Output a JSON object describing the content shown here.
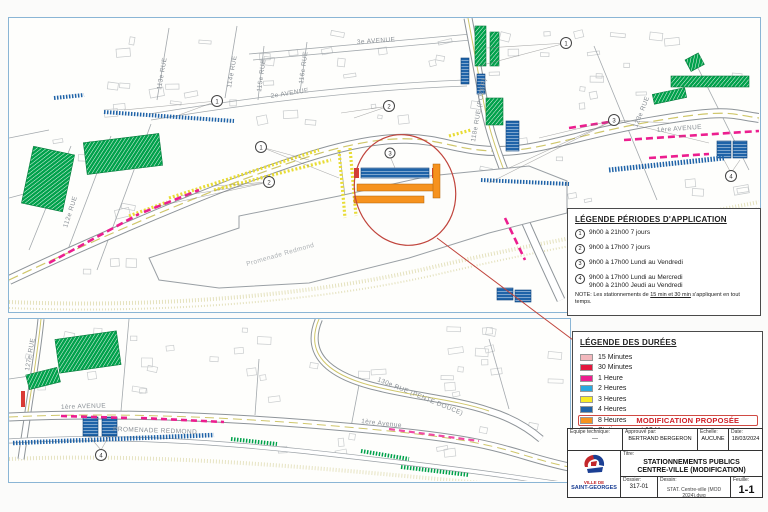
{
  "doc": {
    "type_note": "Scanned municipal parking plan sheet"
  },
  "colors": {
    "panel_border": "#8ab5d5",
    "magenta": "#ec1e8f",
    "yellow": "#efe33a",
    "green": "#00a14b",
    "blue_dark": "#1f63a8",
    "blue_light": "#2aa9e0",
    "orange": "#f6921e",
    "red": "#d93a35",
    "pink_15min": "#f2b8bd",
    "red_30min": "#e3173e",
    "callout_red": "#c0443c"
  },
  "top_map": {
    "labels": {
      "ave3": "3e AVENUE",
      "ave2": "2e AVENUE",
      "ave1": "1ère AVENUE",
      "rue112": "112e RUE",
      "rue113": "113e RUE",
      "rue114": "114e RUE",
      "rue115": "115e RUE",
      "rue116": "116e RUE",
      "rue118": "118e RUE (POZER)",
      "rue123": "123e RUE",
      "promenade": "Promenade Redmond"
    },
    "markers": [
      "1",
      "2",
      "1",
      "2",
      "1",
      "3",
      "3",
      "4"
    ]
  },
  "bottom_map": {
    "labels": {
      "rue127": "127e RUE",
      "ave1": "1ère AVENUE",
      "ave1b": "1ère Avenue",
      "rue130": "130e RUE (PENTE DOUCE)",
      "promenade": "PROMENADE REDMOND"
    },
    "markers": [
      "4"
    ]
  },
  "legend_periods": {
    "title": "LÉGENDE PÉRIODES D'APPLICATION",
    "items": [
      {
        "num": "1",
        "lines": [
          "9h00 à 21h00 7 jours"
        ]
      },
      {
        "num": "2",
        "lines": [
          "9h00 à 17h00 7 jours"
        ]
      },
      {
        "num": "3",
        "lines": [
          "9h00 à 17h00 Lundi au Vendredi"
        ]
      },
      {
        "num": "4",
        "lines": [
          "9h00 à 17h00 Lundi au Mercredi",
          "9h00 à 21h00 Jeudi au Vendredi"
        ]
      }
    ],
    "note_prefix": "NOTE: Les stationnements de ",
    "note_underline": "15 min et 30 min",
    "note_suffix": " s'appliquent en tout temps."
  },
  "legend_durations": {
    "title": "LÉGENDE DES DURÉES",
    "items": [
      {
        "label": "15 Minutes",
        "color": "#f2b8bd"
      },
      {
        "label": "30 Minutes",
        "color": "#e3173e"
      },
      {
        "label": "1 Heure",
        "color": "#ec1e8f"
      },
      {
        "label": "2 Heures",
        "color": "#2aa9e0"
      },
      {
        "label": "3 Heures",
        "color": "#f8ec24"
      },
      {
        "label": "4 Heures",
        "color": "#1f63a8"
      },
      {
        "label": "8 Heures",
        "color": "#f6921e",
        "modification": true
      },
      {
        "label": "Stationnement 12 Heures",
        "color": "#00a14b"
      },
      {
        "label": "Stationnement avec location possible",
        "hatch": true
      }
    ],
    "modification_label": "MODIFICATION PROPOSÉE"
  },
  "title_block": {
    "equipe_label": "Équipe technique:",
    "equipe_value": "---",
    "approuve_label": "Approuvé par:",
    "approuve_value": "BERTRAND BERGERON",
    "echelle_label": "Échelle:",
    "echelle_value": "AUCUNE",
    "date_label": "Date:",
    "date_value": "18/03/2024",
    "titre_label": "Titre:",
    "titre_line1": "STATIONNEMENTS PUBLICS",
    "titre_line2": "CENTRE-VILLE (MODIFICATION)",
    "dossier_label": "Dossier:",
    "dossier_value": "317-01",
    "dessin_label": "Dessin:",
    "dessin_value": "STAT. Centre-ville (MOD 2024).dwg",
    "feuille_label": "Feuille:",
    "feuille_value": "1-1",
    "logo_line1": "VILLE DE",
    "logo_line2": "SAINT-GEORGES"
  }
}
